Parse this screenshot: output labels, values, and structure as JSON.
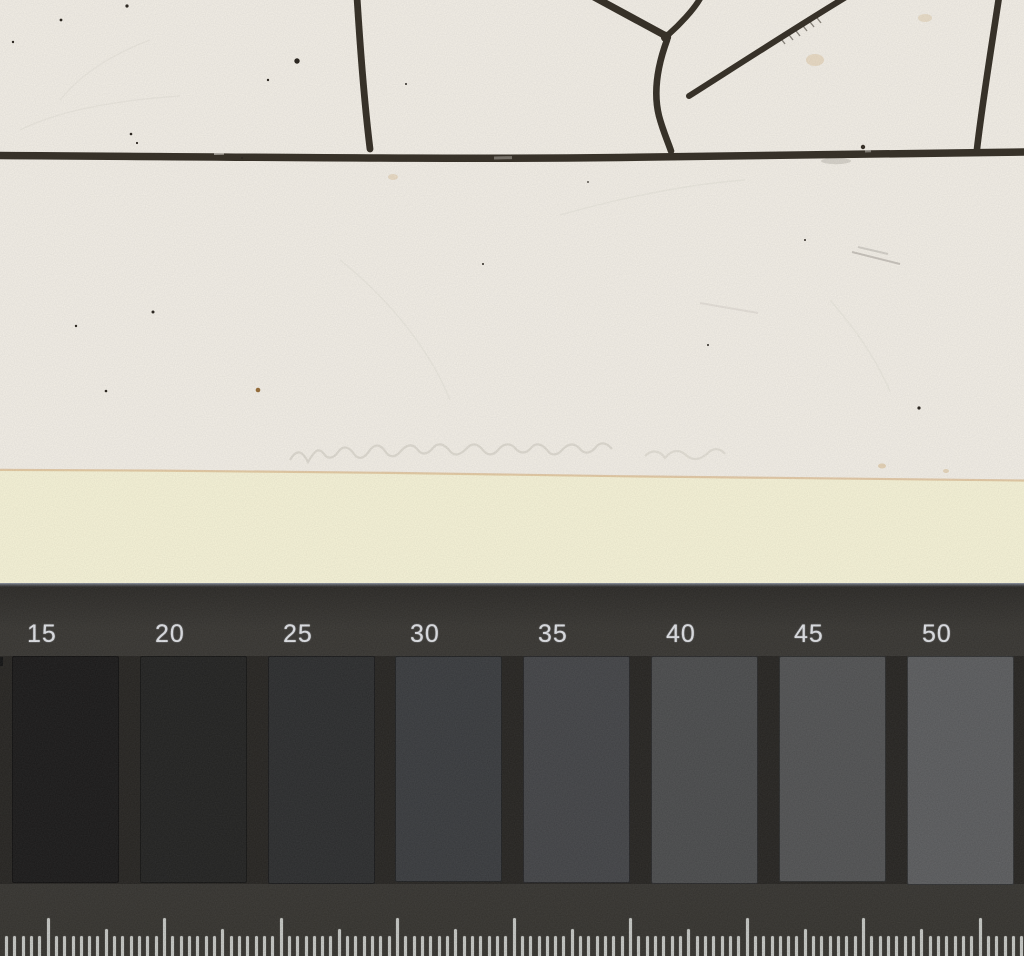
{
  "colors": {
    "paper": "#f4f0e8",
    "mat": "#f7f4d9",
    "ink": "#3a342b",
    "pencil": "#8b857c",
    "paper_edge": "#d8b382",
    "bar_bg": "#393734",
    "step_row_bg": "#282623",
    "label_text": "#e7e9ed",
    "tick": "#cbcdc9"
  },
  "calibration_bar": {
    "steps": [
      {
        "label": "15",
        "color": "#1c1b1b"
      },
      {
        "label": "20",
        "color": "#242423"
      },
      {
        "label": "25",
        "color": "#2e2f30"
      },
      {
        "label": "30",
        "color": "#3c3e41"
      },
      {
        "label": "35",
        "color": "#46474a"
      },
      {
        "label": "40",
        "color": "#4e4f50"
      },
      {
        "label": "45",
        "color": "#555657"
      },
      {
        "label": "50",
        "color": "#5f6062"
      }
    ]
  },
  "ruler": {
    "tick_pitch_px": 8.3214,
    "major_every": 14,
    "medium_every": 7,
    "first_major_x": 46.6
  }
}
